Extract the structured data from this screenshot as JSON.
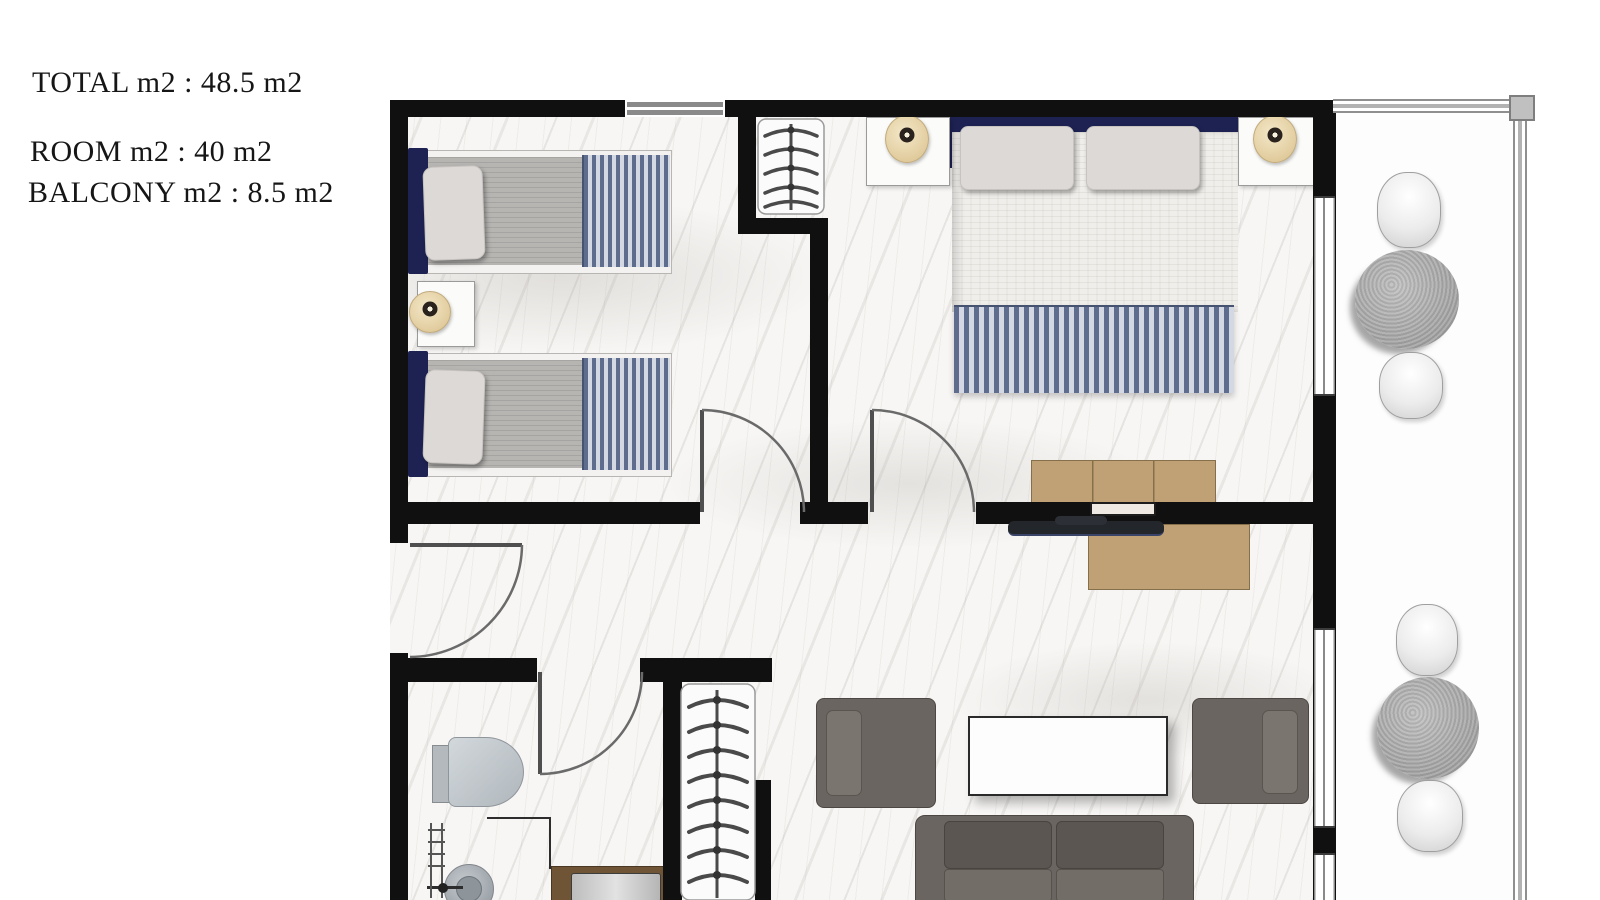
{
  "floor_plan": {
    "labels": {
      "total": "TOTAL m2 : 48.5 m2",
      "room": "ROOM m2 : 40 m2",
      "balcony": "BALCONY m2 : 8.5 m2"
    },
    "colors": {
      "wall": "#101010",
      "marble_floor": "#f7f6f4",
      "headboard_navy": "#1d2253",
      "blanket_stripe_dark": "#5e6d8e",
      "blanket_stripe_light": "#d3d8e2",
      "wood_tan": "#c0a175",
      "sofa_gray": "#6a6560",
      "lamp_beige": "#e9d6a9",
      "balcony_table_gray": "#a8a8a8",
      "toilet_gray": "#c0c7cc"
    }
  }
}
